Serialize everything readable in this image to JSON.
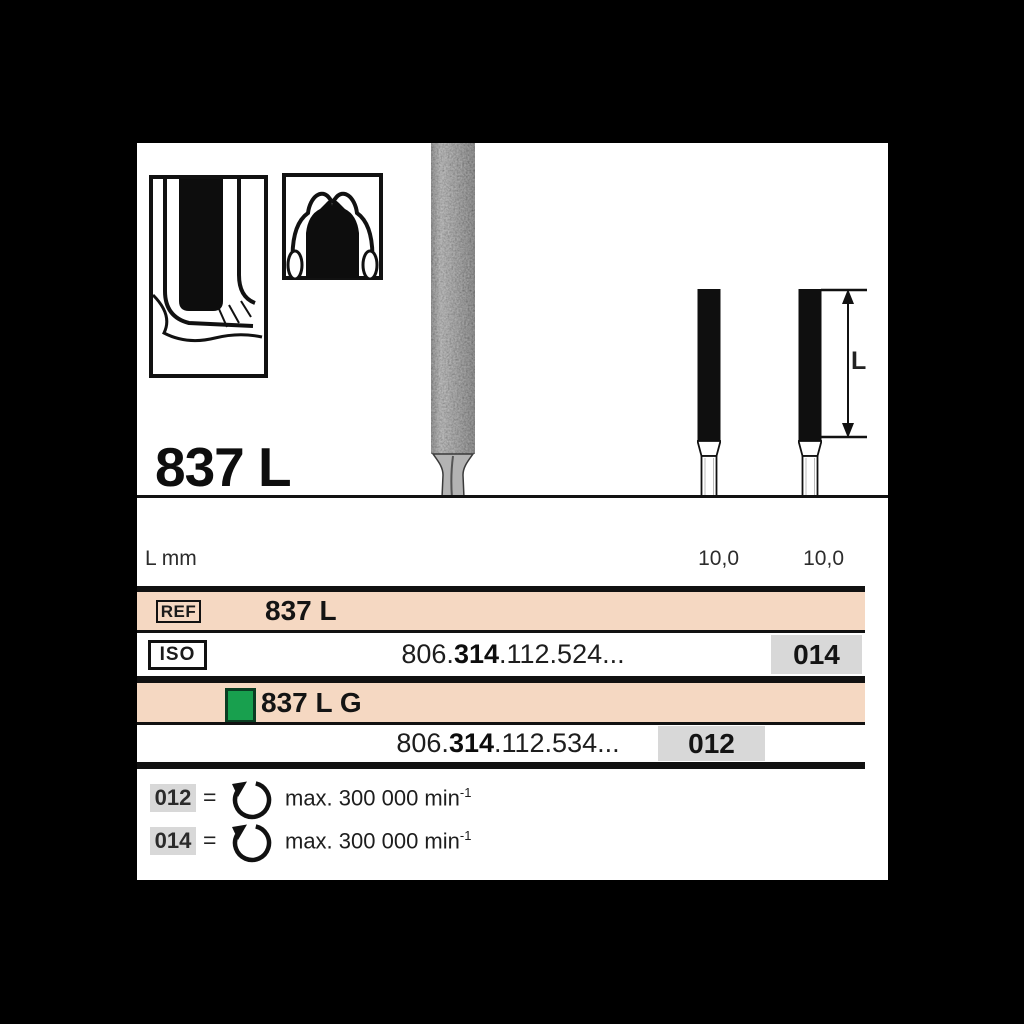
{
  "figure": {
    "title": "837 L",
    "dim_letter": "L",
    "icons": {
      "icon1": "crown-margin-prep",
      "icon2": "occlusal-reduction",
      "photo": "diamond-bur"
    }
  },
  "table": {
    "dim_label": "L mm",
    "dim_values": [
      "10,0",
      "10,0"
    ],
    "ref_badge": "REF",
    "ref_value": "837 L",
    "iso_badge": "ISO",
    "variant_label": "837 L G",
    "rows": [
      {
        "prefix": "806.",
        "bold": "314",
        "suffix": ".112.524...",
        "size": "014"
      },
      {
        "prefix": "806.",
        "bold": "314",
        "suffix": ".112.534...",
        "size": "012"
      }
    ]
  },
  "legend": {
    "rows": [
      {
        "code": "012",
        "eq": "=",
        "speed": "max. 300 000 min",
        "exp": "-1"
      },
      {
        "code": "014",
        "eq": "=",
        "speed": "max. 300 000 min",
        "exp": "-1"
      }
    ]
  },
  "colors": {
    "highlight_row": "#f5d8c2",
    "size_cell_gray": "#d8d8d8",
    "variant_green": "#18a04e",
    "line": "#111111",
    "canvas_bg": "#000000",
    "sheet_bg": "#ffffff"
  }
}
